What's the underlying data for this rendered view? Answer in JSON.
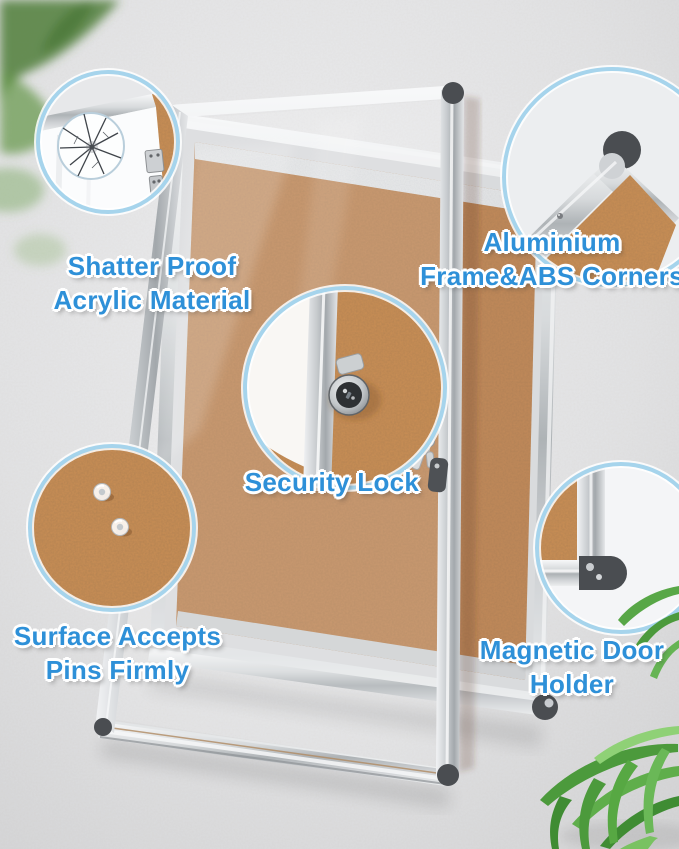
{
  "callouts": [
    {
      "id": "shatter-proof",
      "lines": [
        "Shatter Proof",
        "Acrylic Material"
      ]
    },
    {
      "id": "aluminium-frame",
      "lines": [
        "Aluminium",
        "Frame&ABS Corners"
      ]
    },
    {
      "id": "security-lock",
      "lines": [
        "Security Lock"
      ]
    },
    {
      "id": "pins",
      "lines": [
        "Surface Accepts",
        "Pins Firmly"
      ]
    },
    {
      "id": "magnetic-door",
      "lines": [
        "Magnetic Door",
        "Holder"
      ]
    }
  ],
  "scene": {
    "parts": [
      "cork-board",
      "aluminium-frame",
      "acrylic-door",
      "security-lock",
      "push-pins",
      "magnetic-door-holder",
      "zoom-circles",
      "plant-leaves"
    ]
  },
  "colors": {
    "background": "#e4e5e7",
    "cork": "#c28a5a",
    "cork_zoom": "#ca8f55",
    "frame_silver": "#c6cacd",
    "abs_corner": "#4a4d51",
    "circle_border": "#a6d4ec",
    "label_text": "#2e90d8",
    "label_outline": "#ffffff",
    "leaf_green": "#4f9d3f"
  }
}
